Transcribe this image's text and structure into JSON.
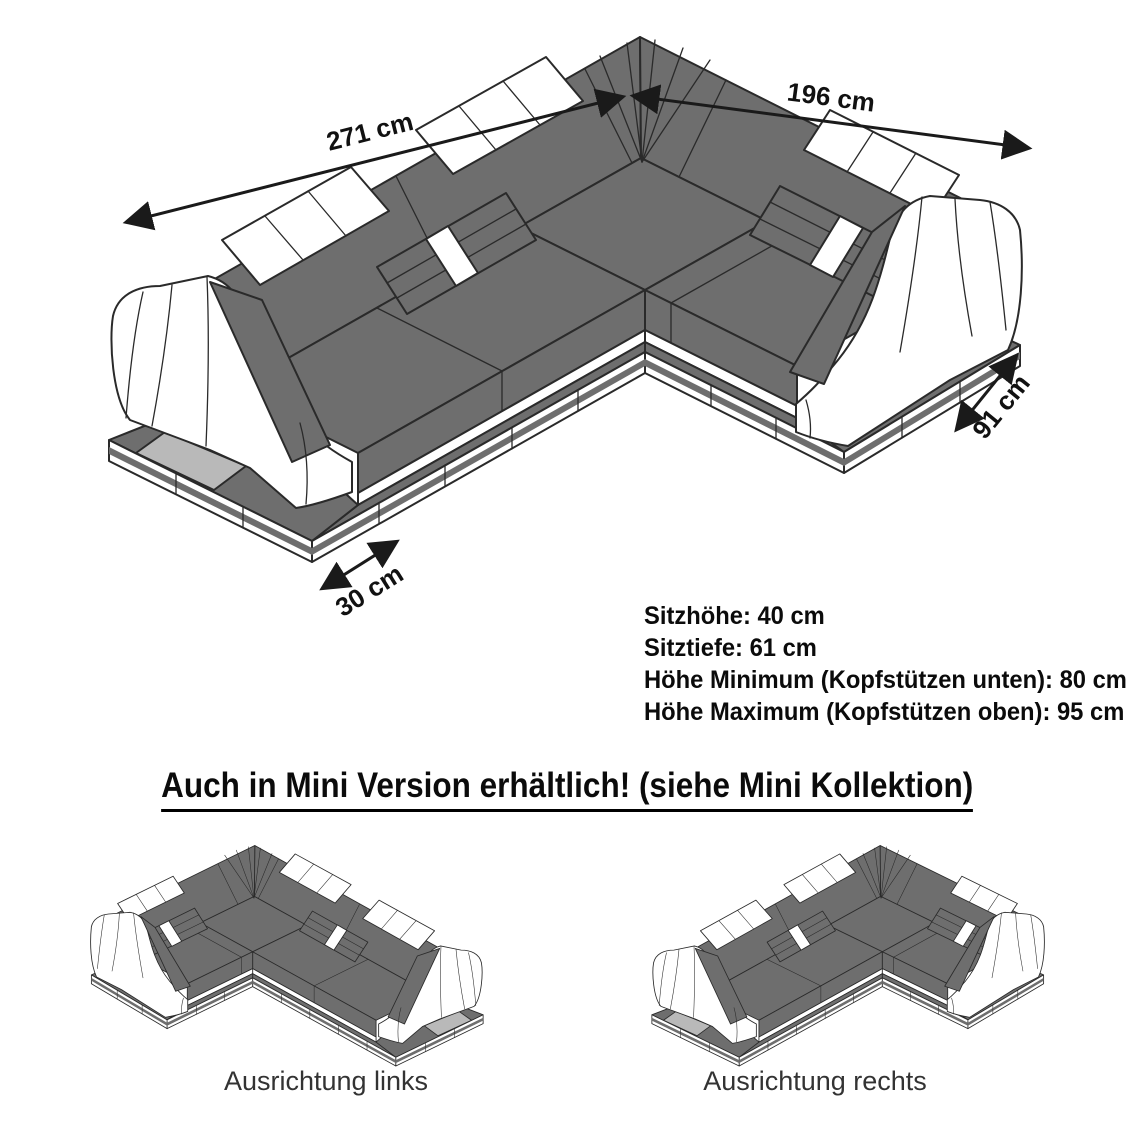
{
  "main_diagram": {
    "dim_back_width": "271 cm",
    "dim_side_width": "196 cm",
    "dim_depth": "91 cm",
    "dim_base": "30 cm"
  },
  "specs": {
    "lines": [
      "Sitzhöhe: 40 cm",
      "Sitztiefe: 61 cm",
      "Höhe Minimum (Kopfstützen unten): 80 cm",
      "Höhe Maximum (Kopfstützen oben): 95 cm"
    ]
  },
  "mini_section": {
    "heading": "Auch in Mini Version erhältlich! (siehe Mini Kollektion)",
    "variant_left": "Ausrichtung links",
    "variant_right": "Ausrichtung rechts"
  },
  "colors": {
    "upholstery_gray": "#6e6e6e",
    "platform_inset_light_gray": "#b9b9b9",
    "upholstery_white": "#ffffff",
    "line_color": "#2a2a2a",
    "text_color": "#0b0b0b"
  }
}
